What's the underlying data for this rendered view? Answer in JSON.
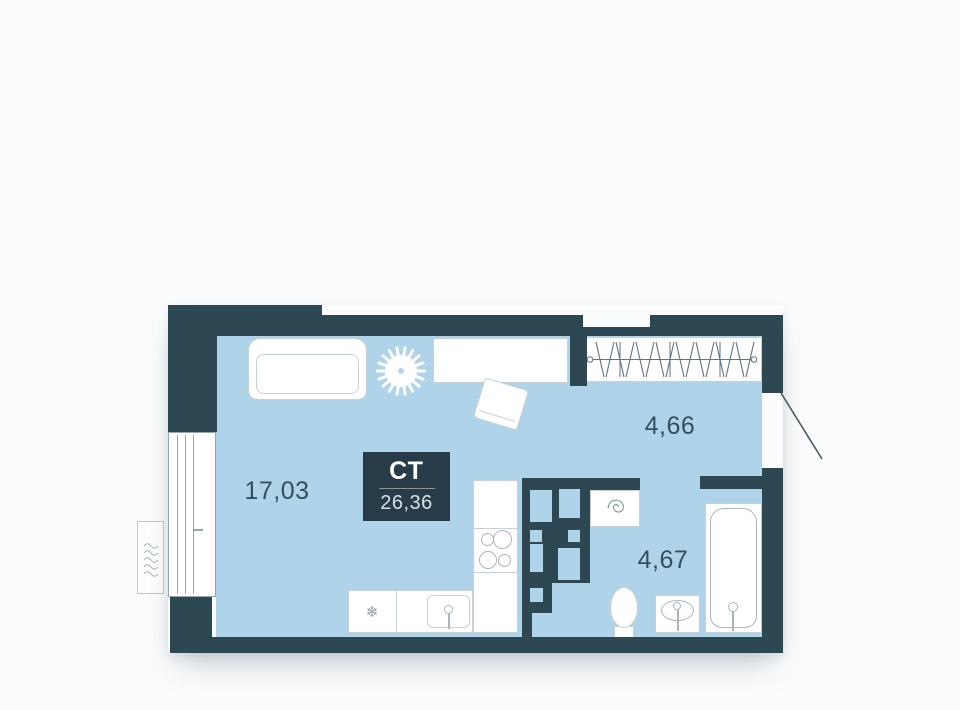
{
  "plan": {
    "unit_type_label": "СТ",
    "total_area": "26,36",
    "rooms": [
      {
        "name": "living-kitchen-room",
        "area_label": "17,03"
      },
      {
        "name": "hallway",
        "area_label": "4,66"
      },
      {
        "name": "bathroom",
        "area_label": "4,67"
      }
    ]
  },
  "icons": {
    "fridge_glyph": "❄"
  },
  "colors": {
    "wall": "#2d4753",
    "floor": "#afd3e8",
    "badge_bg": "#273c48",
    "label_text": "#33505e",
    "furniture_border": "#c6d0d6",
    "fixture_line": "#aab6bc",
    "window_line": "#97a6ae",
    "door_line": "#46575f",
    "hatch_line": "#5f7380",
    "glyph": "#8d9ba1",
    "page_bg": "#fbfcfd",
    "badge_text": "#ffffff",
    "badge_subtext": "#d7e0e5"
  }
}
